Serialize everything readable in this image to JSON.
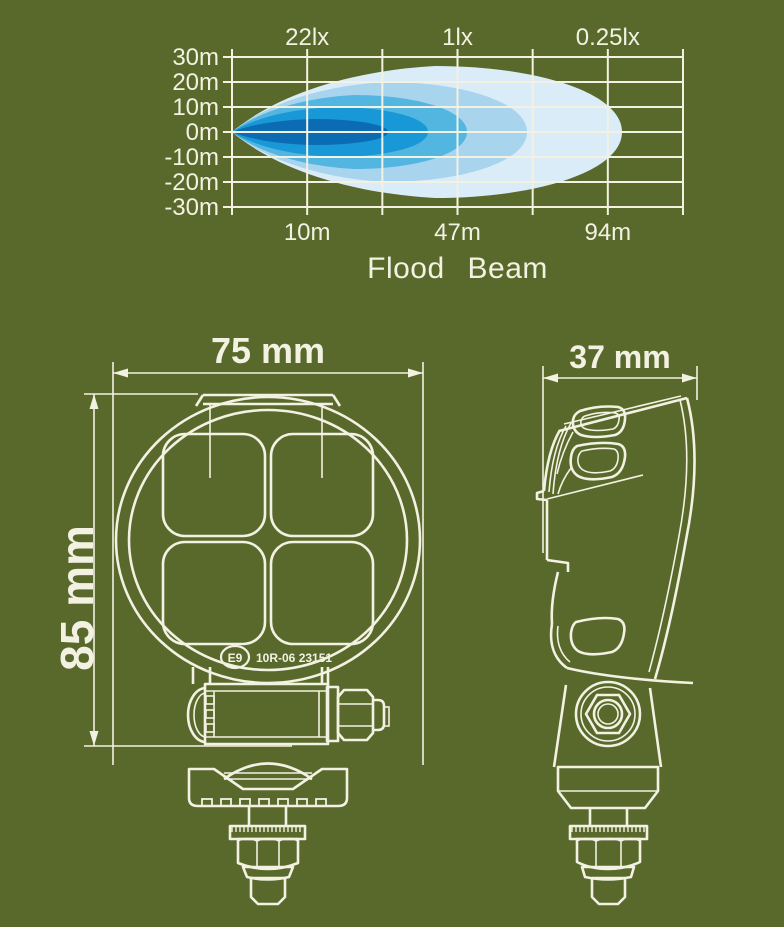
{
  "colors": {
    "background": "#59692c",
    "line": "#f2f1e2",
    "beam_palette": [
      "#d9ecf8",
      "#a9d4ee",
      "#52b6e1",
      "#1898d6",
      "#0b6cb4"
    ]
  },
  "chart_data": {
    "type": "area",
    "title": "Flood Beam",
    "description": "Flood beam iso-lux light distribution pattern",
    "top_axis_ticks": [
      {
        "frac": 0.1667,
        "label": "22lx"
      },
      {
        "frac": 0.5,
        "label": "1lx"
      },
      {
        "frac": 0.8333,
        "label": "0.25lx"
      }
    ],
    "bottom_axis_ticks": [
      {
        "frac": 0.1667,
        "label": "10m"
      },
      {
        "frac": 0.5,
        "label": "47m"
      },
      {
        "frac": 0.8333,
        "label": "94m"
      }
    ],
    "y_axis_ticks": [
      {
        "frac": 0.0,
        "label": "30m"
      },
      {
        "frac": 0.1667,
        "label": "20m"
      },
      {
        "frac": 0.3333,
        "label": "10m"
      },
      {
        "frac": 0.5,
        "label": "0m"
      },
      {
        "frac": 0.6667,
        "label": "-10m"
      },
      {
        "frac": 0.8333,
        "label": "-20m"
      },
      {
        "frac": 1.0,
        "label": "-30m"
      }
    ],
    "labeled_points": [
      {
        "distance_m": 10,
        "illuminance_lx": 22
      },
      {
        "distance_m": 47,
        "illuminance_lx": 1
      },
      {
        "distance_m": 94,
        "illuminance_lx": 0.25
      }
    ],
    "grid": {
      "cols": 6,
      "rows": 6,
      "grid_on": true
    },
    "plot_px": {
      "x": 232,
      "y": 57,
      "w": 451,
      "h": 150
    },
    "beam_origin_frac_y": 0.5,
    "contours": [
      {
        "color": "#d9ecf8",
        "reach_m_est": 97,
        "half_spread_m_est": 26,
        "len_px": 390,
        "half_h_px": 66
      },
      {
        "color": "#a9d4ee",
        "reach_m_est": 69,
        "half_spread_m_est": 20,
        "len_px": 295,
        "half_h_px": 50
      },
      {
        "color": "#52b6e1",
        "reach_m_est": 50,
        "half_spread_m_est": 15,
        "len_px": 235,
        "half_h_px": 37
      },
      {
        "color": "#1898d6",
        "reach_m_est": 40,
        "half_spread_m_est": 10,
        "len_px": 196,
        "half_h_px": 25
      },
      {
        "color": "#0b6cb4",
        "reach_m_est": 30,
        "half_spread_m_est": 5,
        "len_px": 156,
        "half_h_px": 13
      }
    ]
  },
  "front_view": {
    "width_label": "75 mm",
    "height_label": "85 mm",
    "emark_code": "E9",
    "approval_number": "10R-06 23151"
  },
  "side_view": {
    "depth_label": "37 mm"
  }
}
